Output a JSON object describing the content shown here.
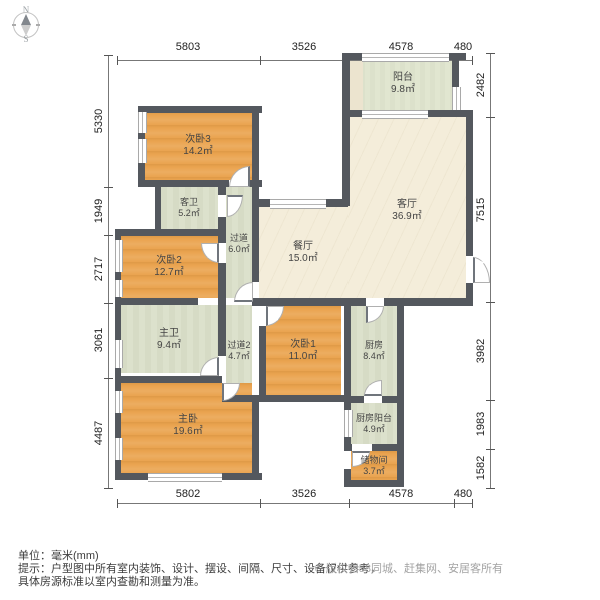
{
  "compass": {
    "north": "N",
    "south": "S"
  },
  "dimensions": {
    "top": [
      "5803",
      "3526",
      "4578",
      "480"
    ],
    "bottom": [
      "5802",
      "3526",
      "4578",
      "480"
    ],
    "left": [
      "5330",
      "1949",
      "2717",
      "3061",
      "4487"
    ],
    "right": [
      "2482",
      "7515",
      "3982",
      "1983",
      "1582"
    ]
  },
  "rooms": {
    "bedroom3": {
      "name": "次卧3",
      "area": "14.2㎡"
    },
    "guest_bath": {
      "name": "客卫",
      "area": "5.2㎡"
    },
    "hallway": {
      "name": "过道",
      "area": "6.0㎡"
    },
    "bedroom2": {
      "name": "次卧2",
      "area": "12.7㎡"
    },
    "master_bath": {
      "name": "主卫",
      "area": "9.4㎡"
    },
    "hallway2": {
      "name": "过道2",
      "area": "4.7㎡"
    },
    "master_bedroom": {
      "name": "主卧",
      "area": "19.6㎡"
    },
    "bedroom1": {
      "name": "次卧1",
      "area": "11.0㎡"
    },
    "dining": {
      "name": "餐厅",
      "area": "15.0㎡"
    },
    "living": {
      "name": "客厅",
      "area": "36.9㎡"
    },
    "balcony": {
      "name": "阳台",
      "area": "9.8㎡"
    },
    "kitchen": {
      "name": "厨房",
      "area": "8.4㎡"
    },
    "kitchen_balcony": {
      "name": "厨房阳台",
      "area": "4.9㎡"
    },
    "storage": {
      "name": "储物间",
      "area": "3.7㎡"
    }
  },
  "footer": {
    "unit": "单位：毫米(mm)",
    "tip": "提示：户型图中所有室内装饰、设计、摆设、间隔、尺寸、设备仅供参考，",
    "tip2": "具体房源标准以室内查勘和测量为准。",
    "copyright": "© 版权归58同城、赶集网、安居客所有"
  },
  "colors": {
    "wall": "#54585e",
    "bedroom_floor": "#eaa44f",
    "bath_kitchen_floor": "#dbe0ca",
    "living_floor": "#f4edda",
    "balcony_floor": "#e0e5cf"
  }
}
